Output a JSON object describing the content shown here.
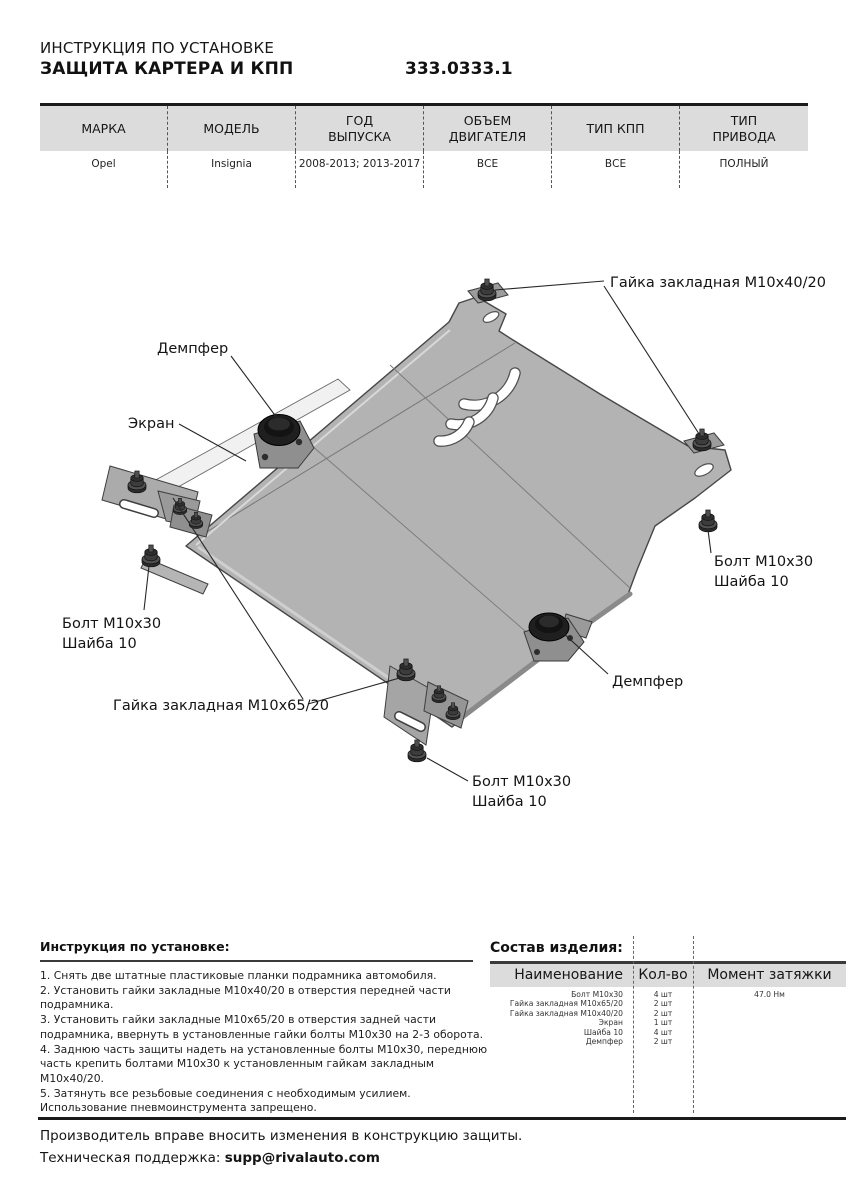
{
  "header": {
    "doc_type": "ИНСТРУКЦИЯ ПО УСТАНОВКЕ",
    "product_name": "ЗАЩИТА КАРТЕРА И КПП",
    "part_number": "333.0333.1"
  },
  "spec_table": {
    "columns": [
      "МАРКА",
      "МОДЕЛЬ",
      "ГОД\nВЫПУСКА",
      "ОБЪЕМ\nДВИГАТЕЛЯ",
      "ТИП КПП",
      "ТИП\nПРИВОДА"
    ],
    "values": [
      "Opel",
      "Insignia",
      "2008-2013; 2013-2017",
      "ВСЕ",
      "ВСЕ",
      "ПОЛНЫЙ"
    ]
  },
  "diagram": {
    "callouts": [
      "Гайка закладная М10х40/20",
      "Демпфер",
      "Экран",
      "Болт М10х30",
      "Шайба 10",
      "Гайка закладная М10х65/20",
      "Болт М10х30",
      "Шайба 10",
      "Демпфер",
      "Болт М10х30",
      "Шайба 10"
    ]
  },
  "install": {
    "heading": "Инструкция по установке:",
    "steps": [
      "1. Снять две штатные пластиковые планки подрамника автомобиля.",
      "2. Установить гайки закладные М10х40/20 в отверстия передней части подрамника.",
      "3. Установить гайки закладные М10х65/20 в отверстия задней части подрамника, ввернуть в установленные гайки болты М10х30 на 2-3 оборота.",
      "4. Заднюю часть защиты надеть на установленные болты М10х30, переднюю часть крепить болтами М10х30 к установленным гайкам закладным М10х40/20.",
      "5. Затянуть все резьбовые соединения с необходимым усилием. Использование пневмоинструмента запрещено."
    ]
  },
  "composition": {
    "heading": "Состав изделия:",
    "columns": [
      "Наименование",
      "Кол-во",
      "Момент затяжки"
    ],
    "rows": [
      {
        "name": "Болт М10х30",
        "qty": "4 шт",
        "torque": "47.0 Нм"
      },
      {
        "name": "Гайка закладная М10х65/20",
        "qty": "2 шт",
        "torque": ""
      },
      {
        "name": "Гайка закладная М10х40/20",
        "qty": "2 шт",
        "torque": ""
      },
      {
        "name": "Экран",
        "qty": "1 шт",
        "torque": ""
      },
      {
        "name": "Шайба 10",
        "qty": "4 шт",
        "torque": ""
      },
      {
        "name": "Демпфер",
        "qty": "2 шт",
        "torque": ""
      }
    ]
  },
  "footer": {
    "line1": "Производитель вправе вносить изменения в конструкцию защиты.",
    "line2_label": "Техническая поддержка: ",
    "line2_email": "supp@rivalauto.com"
  },
  "colors": {
    "plate_gray": "#b3b3b3",
    "band_gray": "#dcdcdc",
    "text": "#141414"
  }
}
